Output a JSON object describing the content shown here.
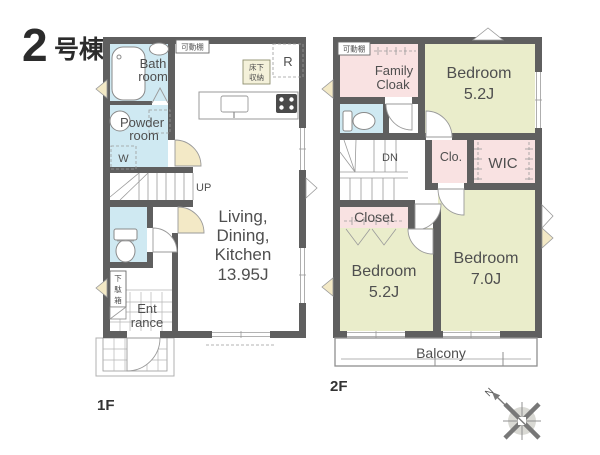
{
  "title": {
    "number": "2",
    "suffix": "号棟"
  },
  "floor1": {
    "floor_label": "1F",
    "bathroom": {
      "line1": "Bath",
      "line2": "room"
    },
    "powder_room": {
      "line1": "Powder",
      "line2": "room",
      "washer": "W"
    },
    "ldk": {
      "line1": "Living,",
      "line2": "Dining,",
      "line3": "Kitchen",
      "size": "13.95J"
    },
    "entrance": {
      "line1": "Ent",
      "line2": "rance"
    },
    "stairs_label": "UP",
    "movable_shelf": "可動棚",
    "underfloor_storage": {
      "line1": "床下",
      "line2": "収納"
    },
    "refrigerator": "R",
    "shoe_cabinet": {
      "char1": "下",
      "char2": "駄",
      "char3": "箱"
    }
  },
  "floor2": {
    "floor_label": "2F",
    "family_cloak": {
      "line1": "Family",
      "line2": "Cloak"
    },
    "bedroom_top": {
      "name": "Bedroom",
      "size": "5.2J"
    },
    "bedroom_left": {
      "name": "Bedroom",
      "size": "5.2J"
    },
    "bedroom_right": {
      "name": "Bedroom",
      "size": "7.0J"
    },
    "closet": "Closet",
    "clo": "Clo.",
    "wic": "WIC",
    "stairs_label": "DN",
    "balcony": "Balcony",
    "movable_shelf": "可動棚"
  },
  "compass": {
    "north": "N"
  },
  "colors": {
    "wall": "#5f5f5f",
    "water_room": "#cfe9f2",
    "closet_room": "#f9e2e2",
    "bedroom_room": "#eaedcb",
    "door": "#f3e9c6",
    "text": "#4f4f4f"
  }
}
